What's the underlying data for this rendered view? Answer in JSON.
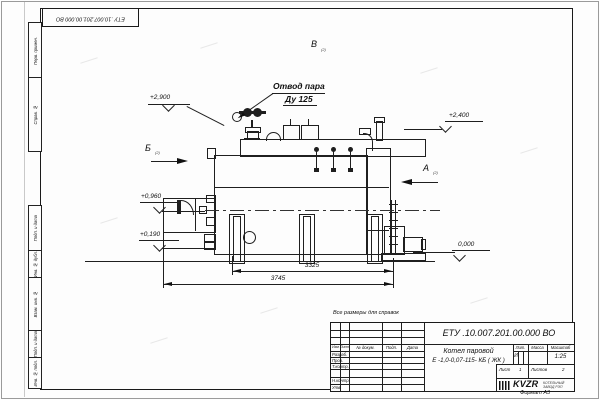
{
  "top_stamp": {
    "doc_number": "ЕТУ .10.007.201.00.000  ВО"
  },
  "side_stamps": {
    "s1": "Перв. примен.",
    "s2": "Справ. №",
    "s3": "Подп. и дата",
    "s4": "Инв. № дубл.",
    "s5": "Взам. инв. №",
    "s6": "Подп. и дата",
    "s7": "Инв. № подл."
  },
  "annotations": {
    "callout_line1": "Отвод пара",
    "callout_line2": "Ду 125",
    "elev_2900": "+2,900",
    "elev_2400": "+2,400",
    "elev_0960": "+0,960",
    "elev_0190": "+0,190",
    "elev_0000": "0,000",
    "dim_3325": "3325",
    "dim_3745": "3745",
    "view_b": "Б",
    "view_v": "В",
    "view_a": "А",
    "view_ref": "(2)"
  },
  "notes": {
    "reference": "Все размеры для справок",
    "format": "Формат А3"
  },
  "title_block": {
    "doc_number": "ЕТУ .10.007.201.00.000  ВО",
    "name1": "Котел паровой",
    "name2": "Е -1,0-0,07-115- КБ ( ЖК )",
    "col_izm": "Изм",
    "col_list": "Лист",
    "col_doc": "№ докум.",
    "col_podp": "Подп.",
    "col_data": "Дата",
    "row1": "Разраб.",
    "row2": "Пров.",
    "row3": "Т.контр.",
    "row4": "Н.контр.",
    "row5": "Утв.",
    "lit": "Лит.",
    "mass": "Масса",
    "scale": "Масштаб",
    "lit_value": "И",
    "scale_value": "1:25",
    "sheet": "Лист",
    "sheet_no": "1",
    "sheets": "Листов",
    "sheets_no": "2",
    "logo": "KVZR",
    "co1": "КОТЕЛЬНЫЙ",
    "co2": "ЗАВОД РЭП"
  }
}
